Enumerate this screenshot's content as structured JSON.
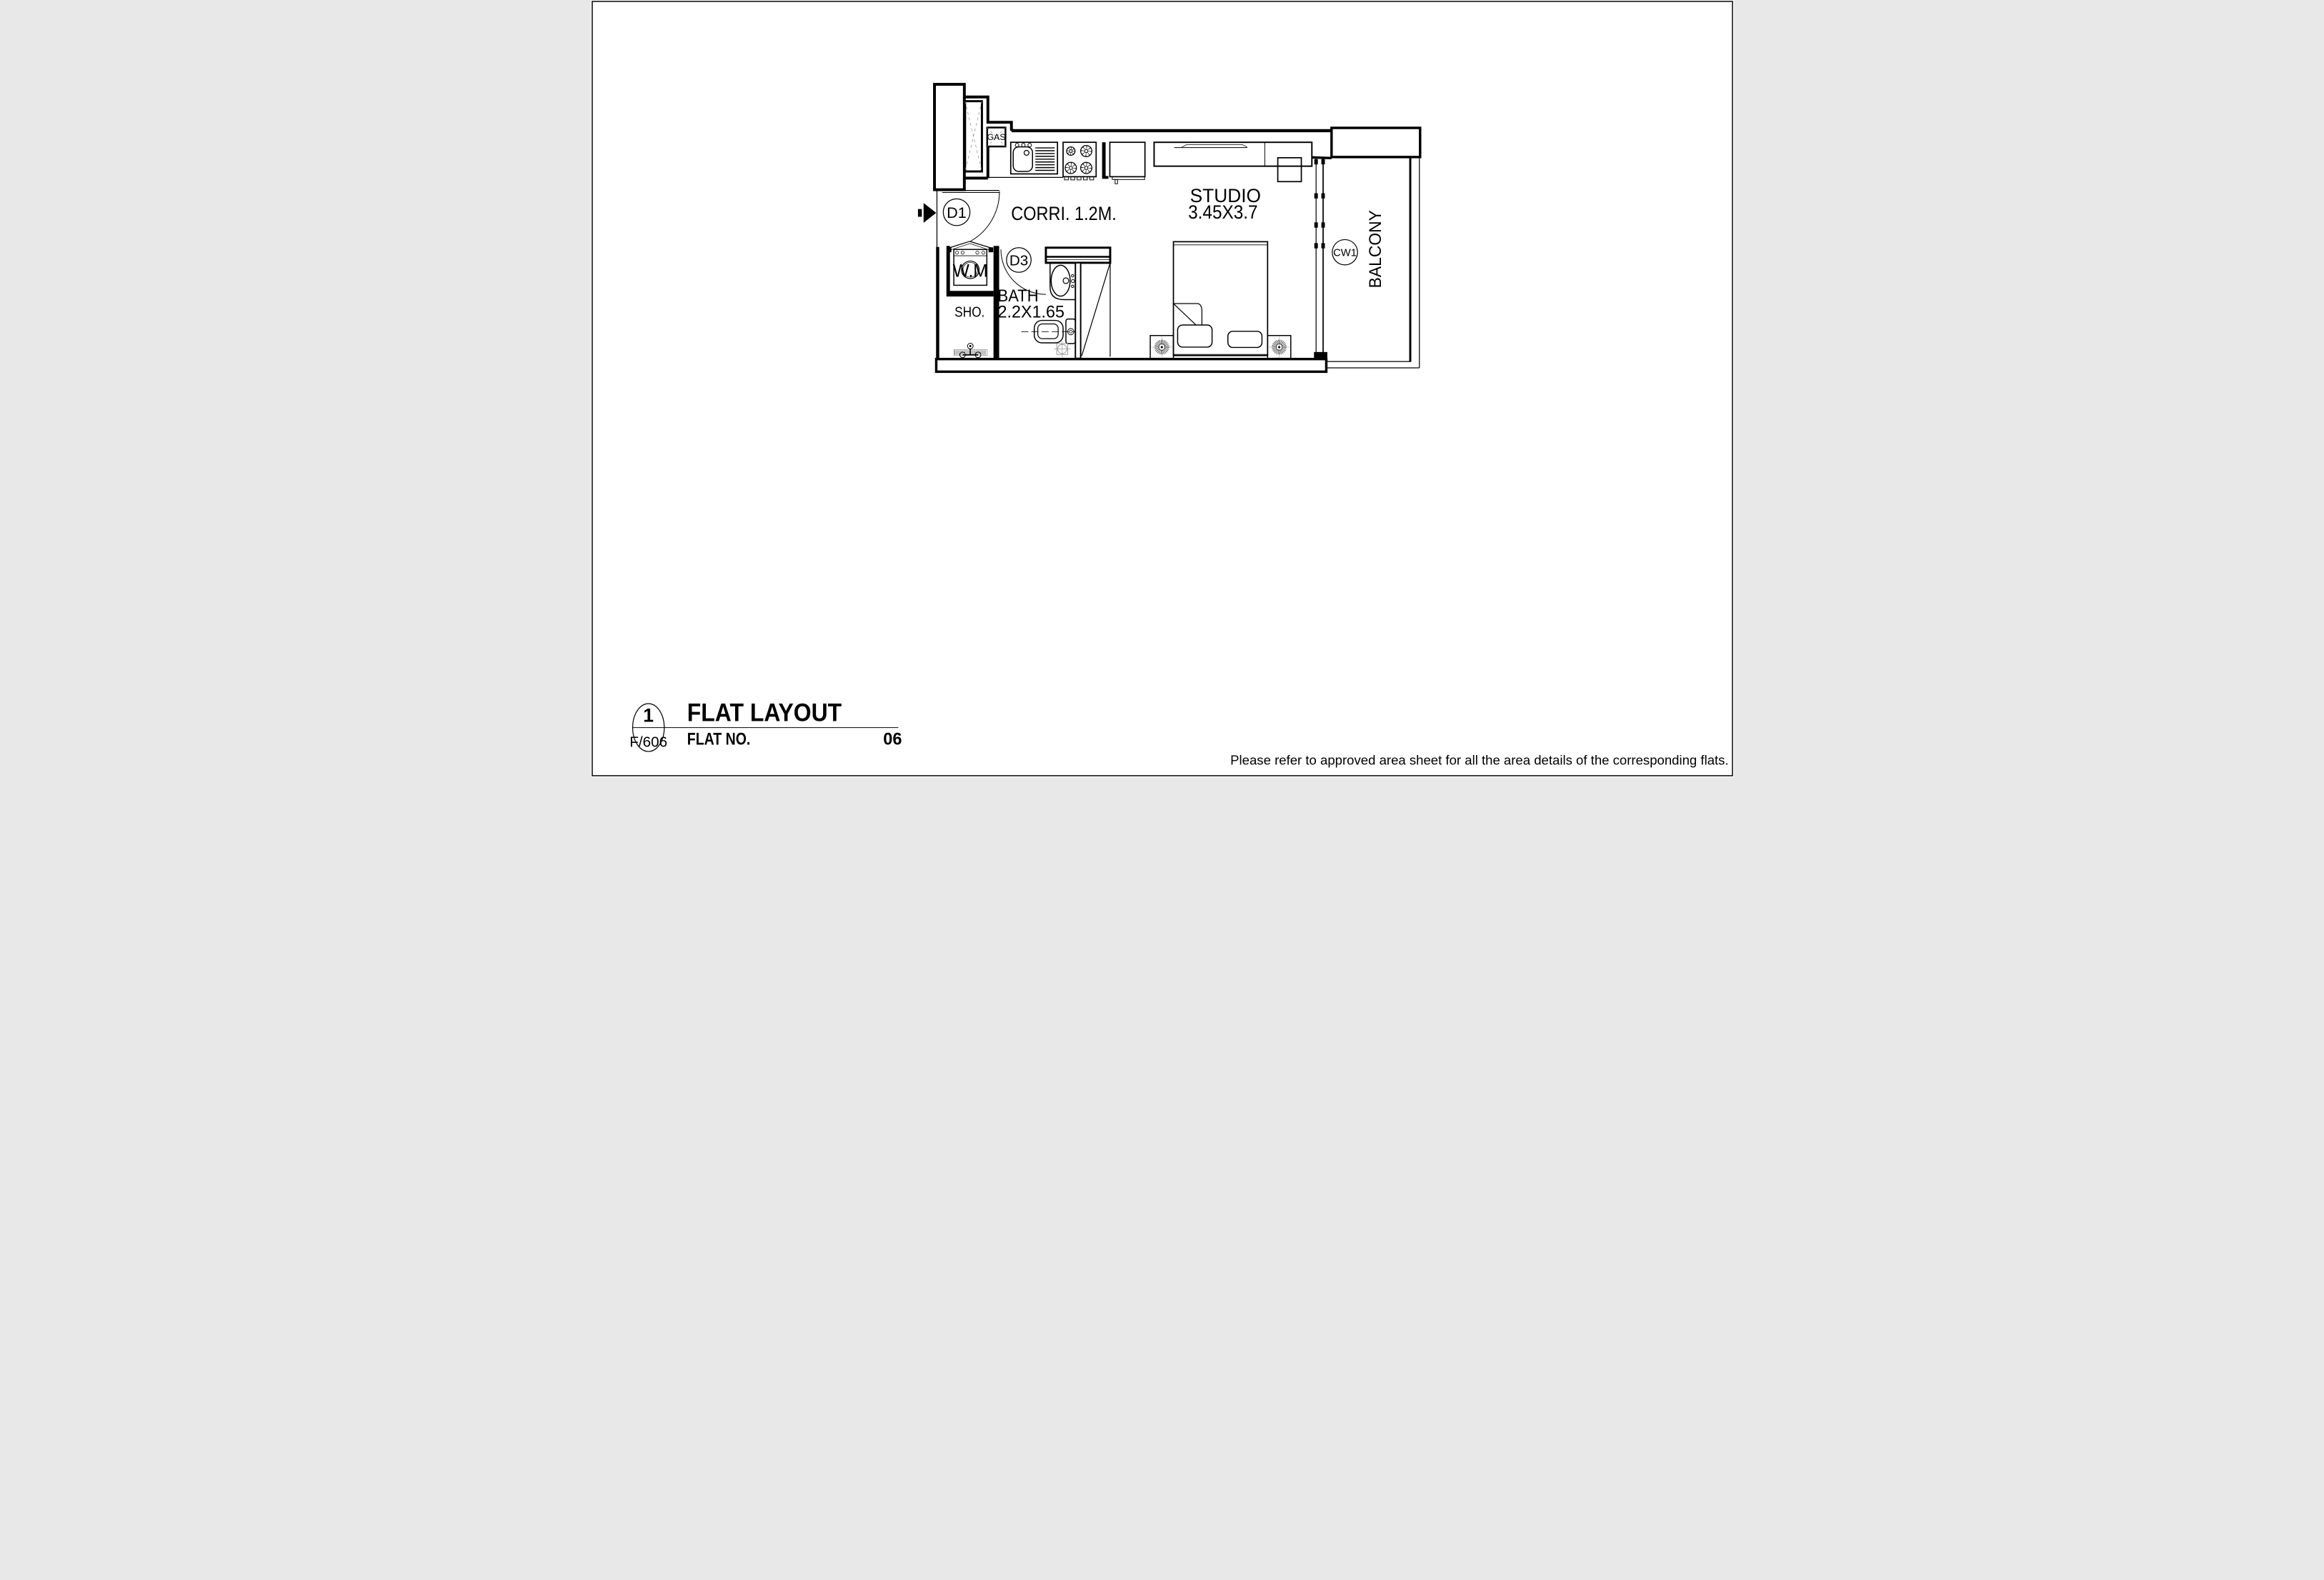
{
  "plan": {
    "rooms": {
      "corridor": "CORRI. 1.2M.",
      "studio_name": "STUDIO",
      "studio_dims": "3.45X3.7",
      "bath_name": "BATH",
      "bath_dims": "2.2X1.65",
      "shower": "SHO.",
      "washing_machine": "W.M",
      "gas": "GAS",
      "balcony": "BALCONY"
    },
    "tags": {
      "door_main": "D1",
      "door_bath": "D3",
      "window": "CW1"
    }
  },
  "title_block": {
    "detail_number": "1",
    "detail_ref": "F/606",
    "title": "FLAT LAYOUT",
    "flat_no_label": "FLAT NO.",
    "flat_no_value": "06"
  },
  "note": "Please refer to approved area sheet for all the area details of the corresponding flats.",
  "colors": {
    "line": "#000000",
    "hatch": "#909090",
    "background": "#ffffff"
  }
}
